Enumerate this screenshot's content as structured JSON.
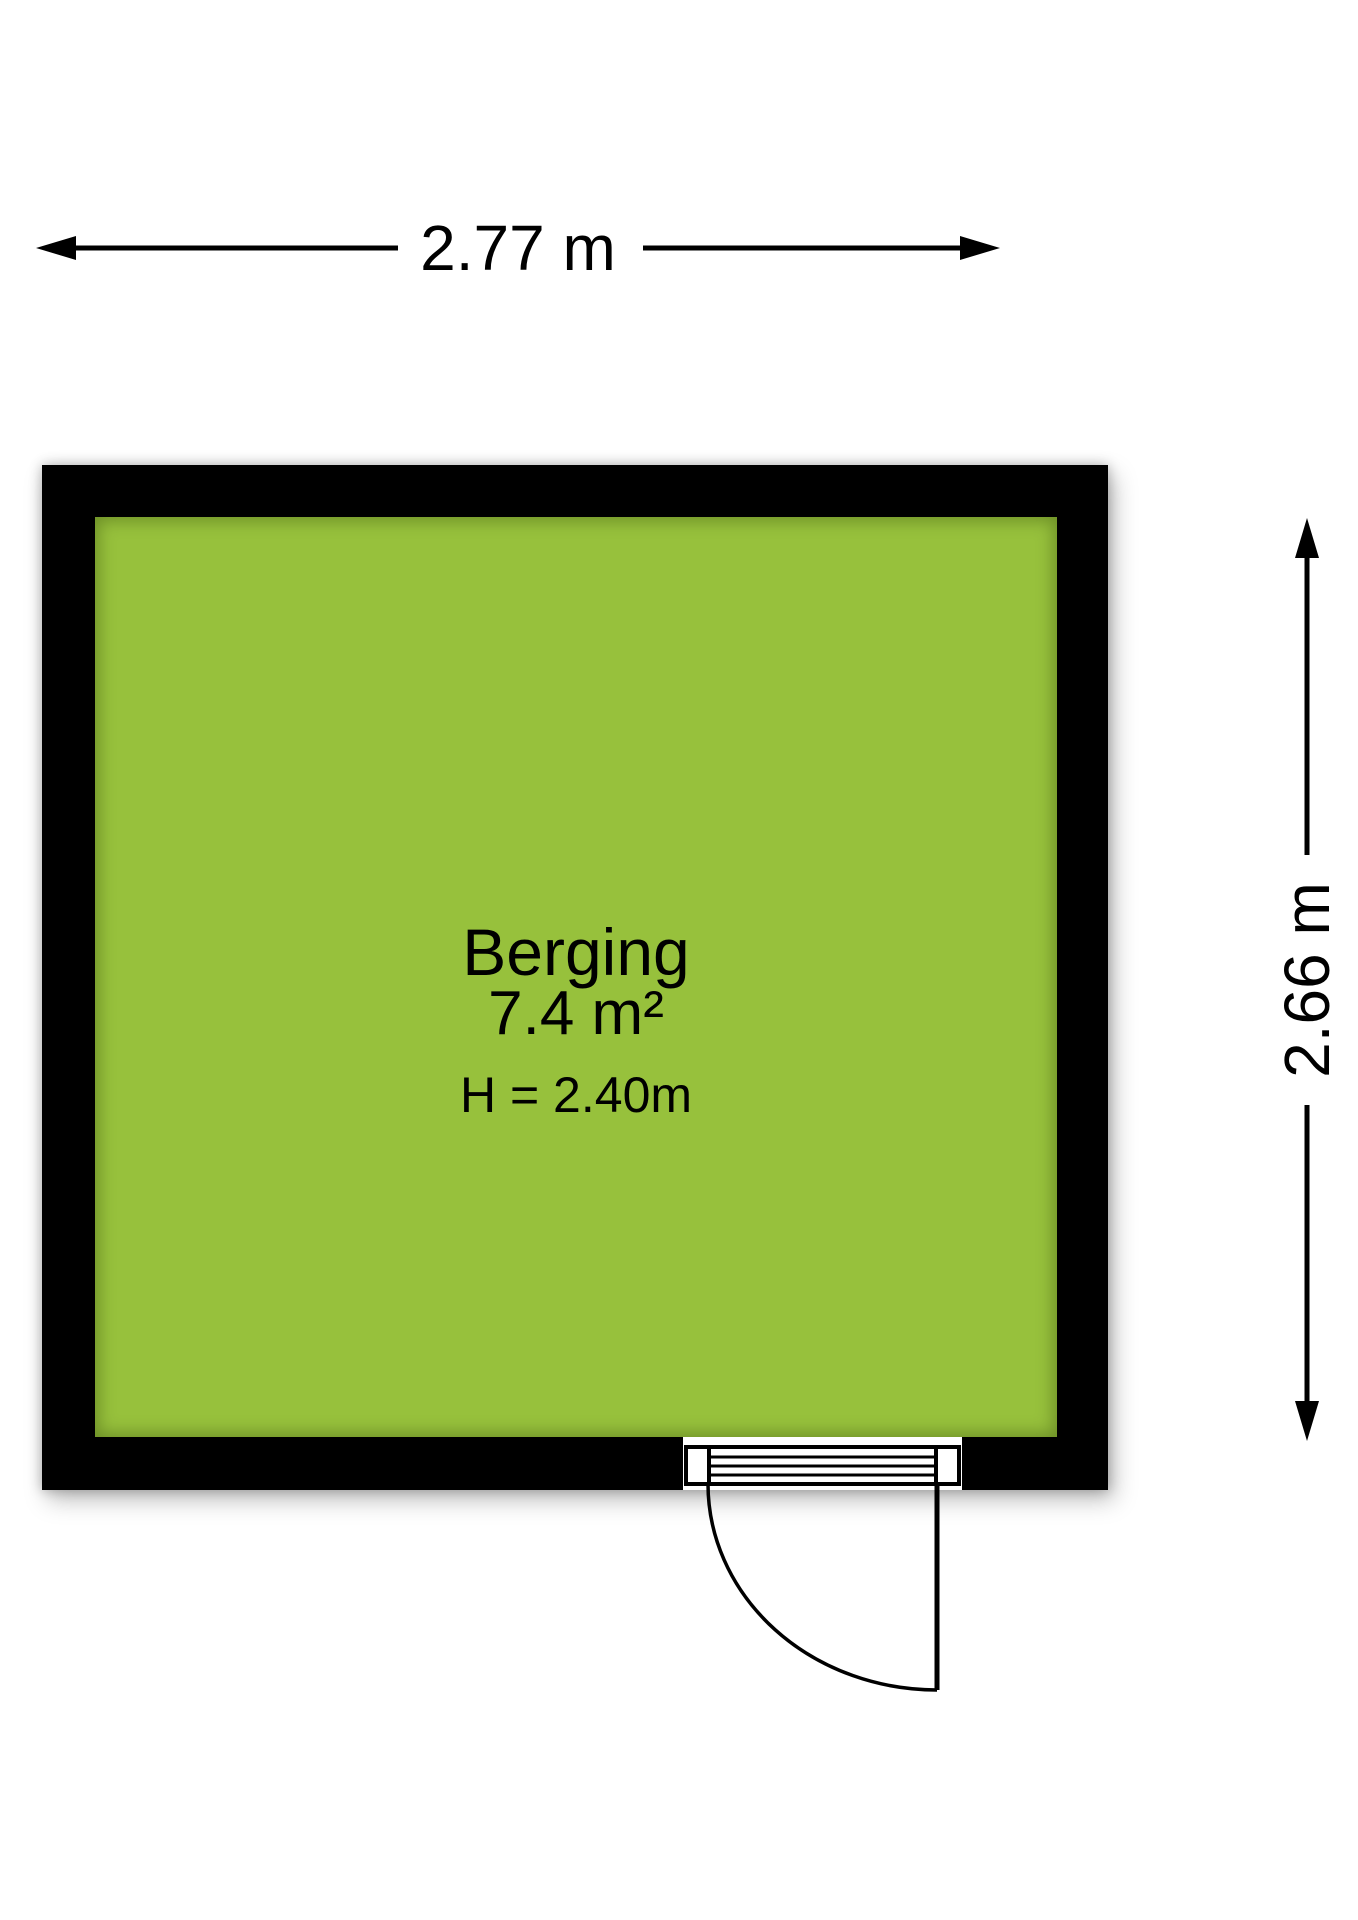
{
  "room": {
    "name": "Berging",
    "area": "7.4 m²",
    "height_label": "H = 2.40m"
  },
  "dimensions": {
    "width_label": "2.77 m",
    "height_label": "2.66 m"
  },
  "door": {
    "type": "single-swing",
    "position": "bottom-right"
  },
  "colors": {
    "floor_green": "#97c13c",
    "wall_black": "#000000",
    "background_white": "#ffffff"
  }
}
